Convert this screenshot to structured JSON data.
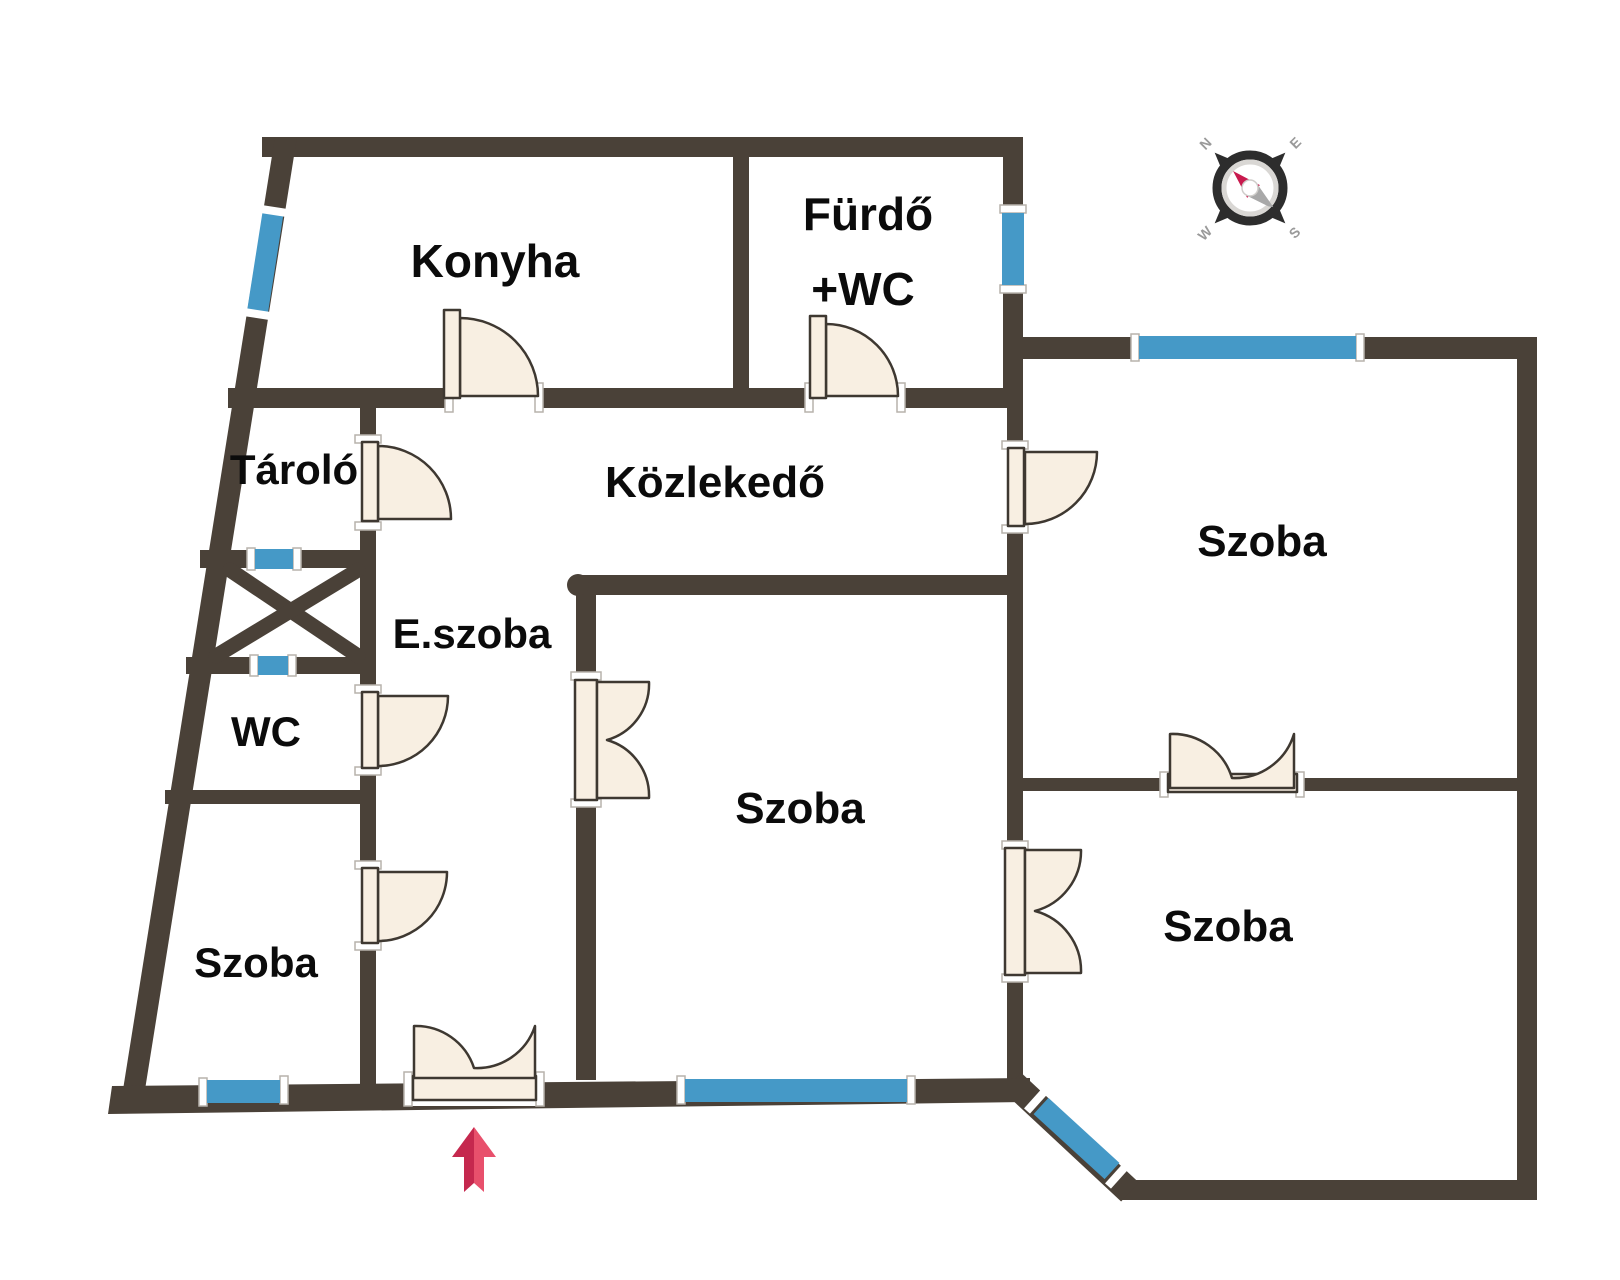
{
  "plan": {
    "type": "floor-plan",
    "rooms": {
      "konyha": {
        "label": "Konyha"
      },
      "furdo": {
        "label": "Fürdő",
        "label2": "+WC"
      },
      "tarolo": {
        "label": "Tároló"
      },
      "kozlekedo": {
        "label": "Közlekedő"
      },
      "eszoba": {
        "label": "E.szoba"
      },
      "wc": {
        "label": "WC"
      },
      "szoba_bottom_left": {
        "label": "Szoba"
      },
      "szoba_center": {
        "label": "Szoba"
      },
      "szoba_top_right": {
        "label": "Szoba"
      },
      "szoba_bottom_right": {
        "label": "Szoba"
      }
    },
    "compass": {
      "n": "N",
      "e": "E",
      "s": "S",
      "w": "W"
    },
    "colors": {
      "wall": "#4a4138",
      "window": "#4599c7",
      "door_fill": "#f8efe2",
      "door_stroke": "#3e3831",
      "arrow_dark": "#c5284e",
      "arrow_light": "#e8506c",
      "compass_ring": "#2d2d2d",
      "compass_needle_red": "#c81a4e",
      "compass_needle_gray": "#a8a8a8"
    }
  }
}
